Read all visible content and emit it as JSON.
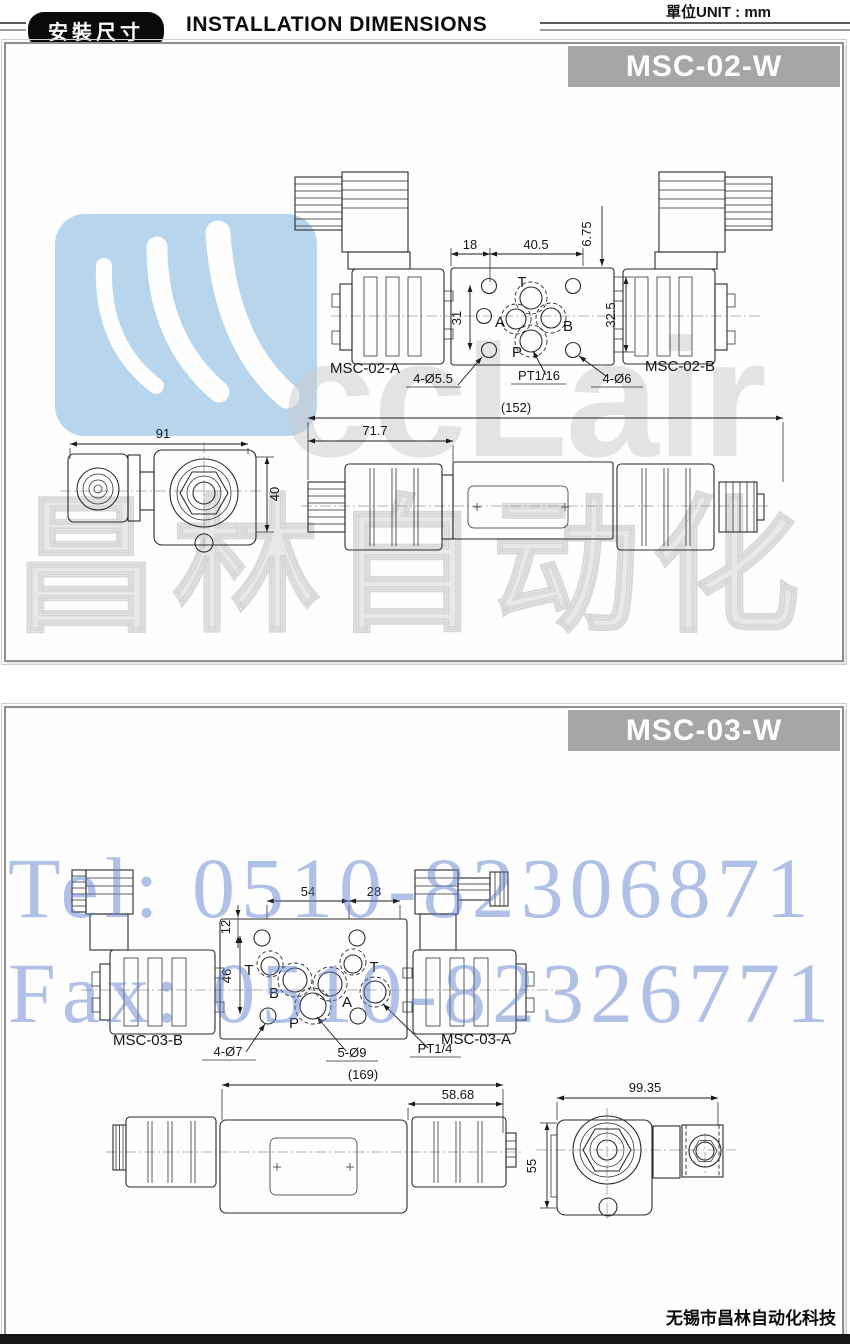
{
  "page": {
    "unit_note": "單位UNIT : mm",
    "badge": "安裝尺寸",
    "title": "INSTALLATION DIMENSIONS",
    "company": "无锡市昌林自动化科技"
  },
  "watermarks": {
    "tel": "Tel: 0510-82306871",
    "fax": "Fax: 0510-82326771",
    "brand_latin": "ccLair",
    "brand_cn": "昌林自动化"
  },
  "panel1": {
    "model": "MSC-02-W",
    "top_view": {
      "dim_18": "18",
      "dim_40_5": "40.5",
      "dim_6_75": "6.75",
      "dim_31": "31",
      "dim_32_5": "32.5",
      "ports": {
        "t": "T",
        "a": "A",
        "b": "B",
        "p": "P"
      },
      "label_left": "MSC-02-A",
      "label_right": "MSC-02-B",
      "leader_holes": "4-Ø5.5",
      "leader_thread": "PT1/16",
      "leader_holes2": "4-Ø6"
    },
    "side_view": {
      "dim_total": "(152)",
      "dim_left": "71.7"
    },
    "end_view": {
      "dim_width": "91",
      "dim_height": "40"
    }
  },
  "panel2": {
    "model": "MSC-03-W",
    "top_view": {
      "dim_54": "54",
      "dim_28": "28",
      "dim_12": "12",
      "dim_46": "46",
      "ports": {
        "t1": "T",
        "b": "B",
        "a": "A",
        "t2": "T",
        "p": "P"
      },
      "label_left": "MSC-03-B",
      "label_right": "MSC-03-A",
      "leader_holes": "4-Ø7",
      "leader_holes2": "5-Ø9",
      "leader_thread": "PT1/4"
    },
    "side_view": {
      "dim_total": "(169)",
      "dim_right": "58.68"
    },
    "end_view": {
      "dim_width": "99.35",
      "dim_height": "55"
    }
  }
}
